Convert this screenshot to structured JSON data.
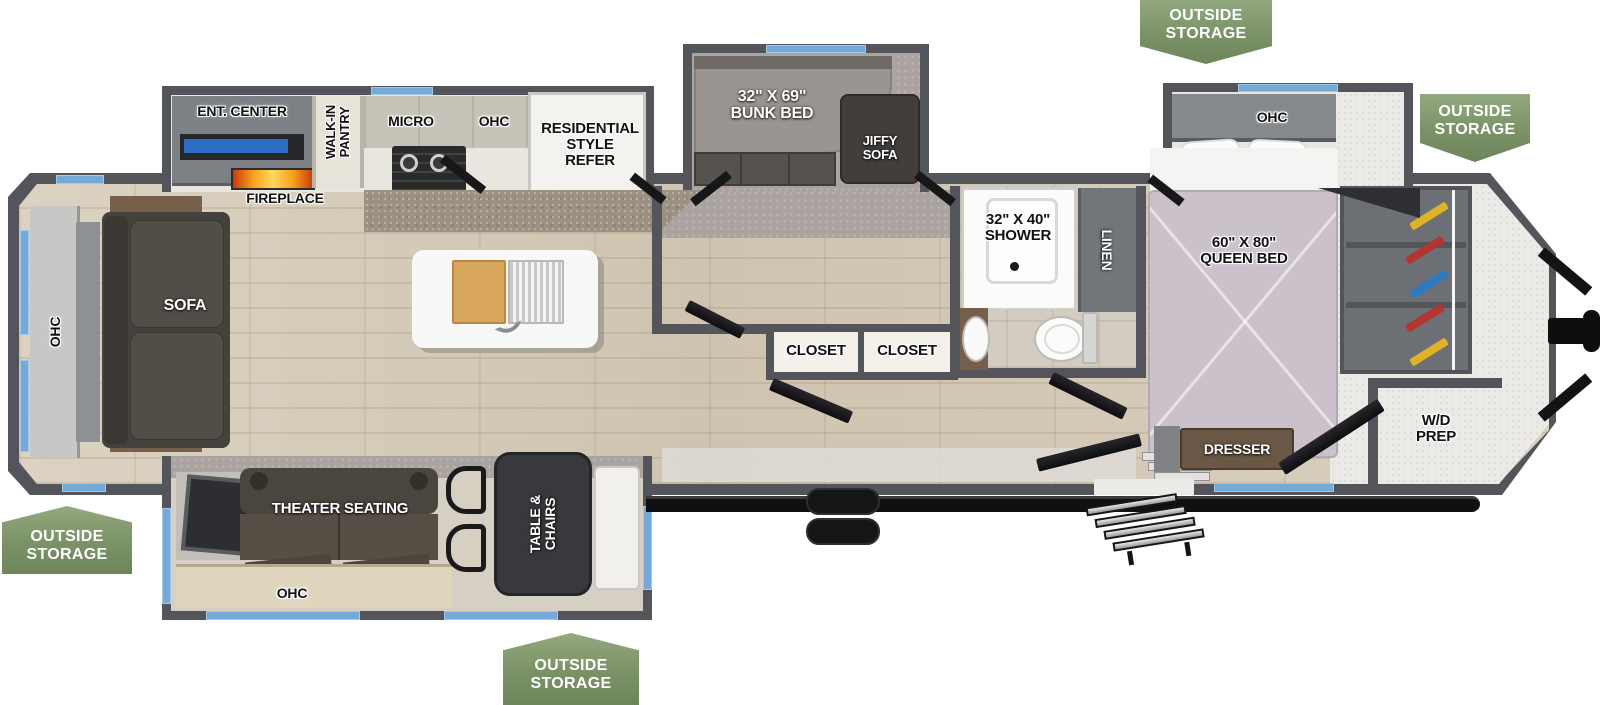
{
  "colors": {
    "wall_gray": "#54555a",
    "window_blue": "#74a9d8",
    "badge_green": "#7b9166",
    "flame_orange": "#f59a1d",
    "bed_lavender": "#cbc1cb",
    "sofa_dark": "#49453f",
    "wood_floor": "#d6cbb9"
  },
  "labels": {
    "outside_storage": "OUTSIDE\nSTORAGE",
    "ent_center": "ENT. CENTER",
    "fireplace": "FIREPLACE",
    "walk_in_pantry": "WALK-IN\nPANTRY",
    "micro": "MICRO",
    "ohc": "OHC",
    "refer": "RESIDENTIAL\nSTYLE\nREFER",
    "sofa": "SOFA",
    "bunk_bed": "32\" X 69\"\nBUNK BED",
    "jiffy_sofa": "JIFFY\nSOFA",
    "closet": "CLOSET",
    "shower": "32\" X 40\"\nSHOWER",
    "linen": "LINEN",
    "queen_bed": "60\" X 80\"\nQUEEN BED",
    "dresser": "DRESSER",
    "wd_prep": "W/D\nPREP",
    "theater_seating": "THEATER SEATING",
    "table_chairs": "TABLE &\nCHAIRS"
  }
}
